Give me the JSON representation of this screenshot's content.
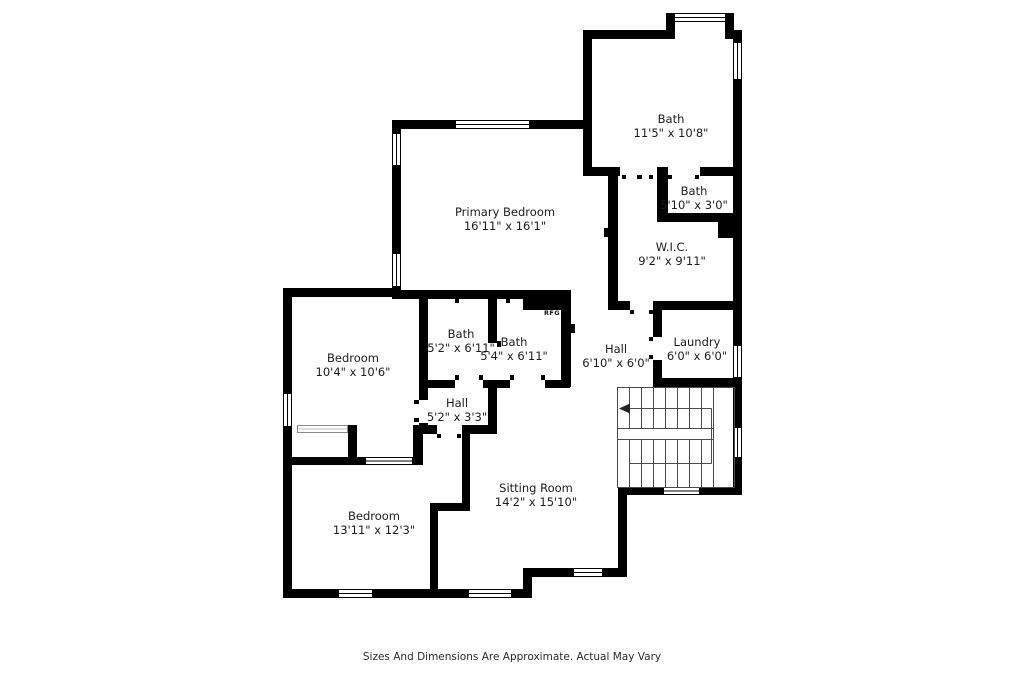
{
  "plan": {
    "rooms": [
      {
        "id": "bath-upper",
        "name": "Bath",
        "dims": "11'5\" x 10'8\""
      },
      {
        "id": "bath-small",
        "name": "Bath",
        "dims": "5'10\" x 3'0\""
      },
      {
        "id": "wic",
        "name": "W.I.C.",
        "dims": "9'2\" x 9'11\""
      },
      {
        "id": "primary",
        "name": "Primary Bedroom",
        "dims": "16'11\" x 16'1\""
      },
      {
        "id": "bedroom-upper",
        "name": "Bedroom",
        "dims": "10'4\" x 10'6\""
      },
      {
        "id": "bath-52",
        "name": "Bath",
        "dims": "5'2\" x 6'11\""
      },
      {
        "id": "bath-54",
        "name": "Bath",
        "dims": "5'4\" x 6'11\""
      },
      {
        "id": "hall-upper",
        "name": "Hall",
        "dims": "6'10\" x 6'0\""
      },
      {
        "id": "laundry",
        "name": "Laundry",
        "dims": "6'0\" x 6'0\""
      },
      {
        "id": "hall-lower",
        "name": "Hall",
        "dims": "5'2\" x 3'3\""
      },
      {
        "id": "bedroom-lower",
        "name": "Bedroom",
        "dims": "13'11\" x 12'3\""
      },
      {
        "id": "sitting",
        "name": "Sitting Room",
        "dims": "14'2\" x 15'10\""
      }
    ],
    "annotations": {
      "rfg": "RFG"
    },
    "footer": "Sizes And Dimensions Are Approximate. Actual May Vary"
  },
  "colors": {
    "wall": "#000000",
    "line": "#4a4a4a",
    "text": "#1c1c1c",
    "background": "#ffffff"
  }
}
